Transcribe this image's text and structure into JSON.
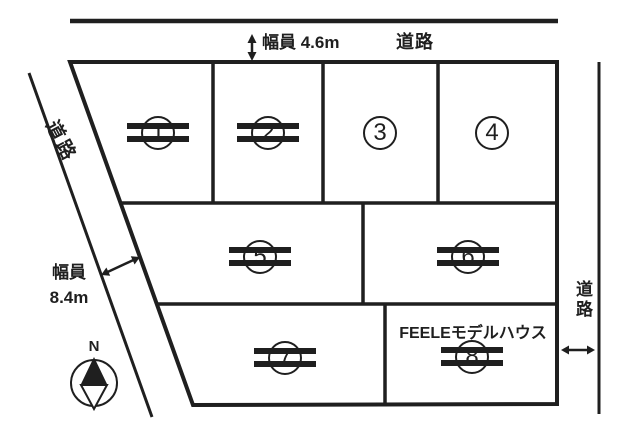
{
  "colors": {
    "ink": "#1f1f1f",
    "background": "#ffffff"
  },
  "annotations": {
    "top_width_label": "幅員 4.6m",
    "top_road_label": "道路",
    "left_road_label": "道路",
    "left_width_title": "幅員",
    "left_width_value": "8.4m",
    "right_road_label": "道路",
    "compass_north": "N",
    "model_house_label": "FEELEモデルハウス"
  },
  "lots": [
    {
      "number": "1",
      "struck_out": true
    },
    {
      "number": "2",
      "struck_out": true
    },
    {
      "number": "3",
      "struck_out": false
    },
    {
      "number": "4",
      "struck_out": false
    },
    {
      "number": "5",
      "struck_out": true
    },
    {
      "number": "6",
      "struck_out": true
    },
    {
      "number": "7",
      "struck_out": true
    },
    {
      "number": "8",
      "struck_out": true,
      "note": "FEELEモデルハウス"
    }
  ]
}
